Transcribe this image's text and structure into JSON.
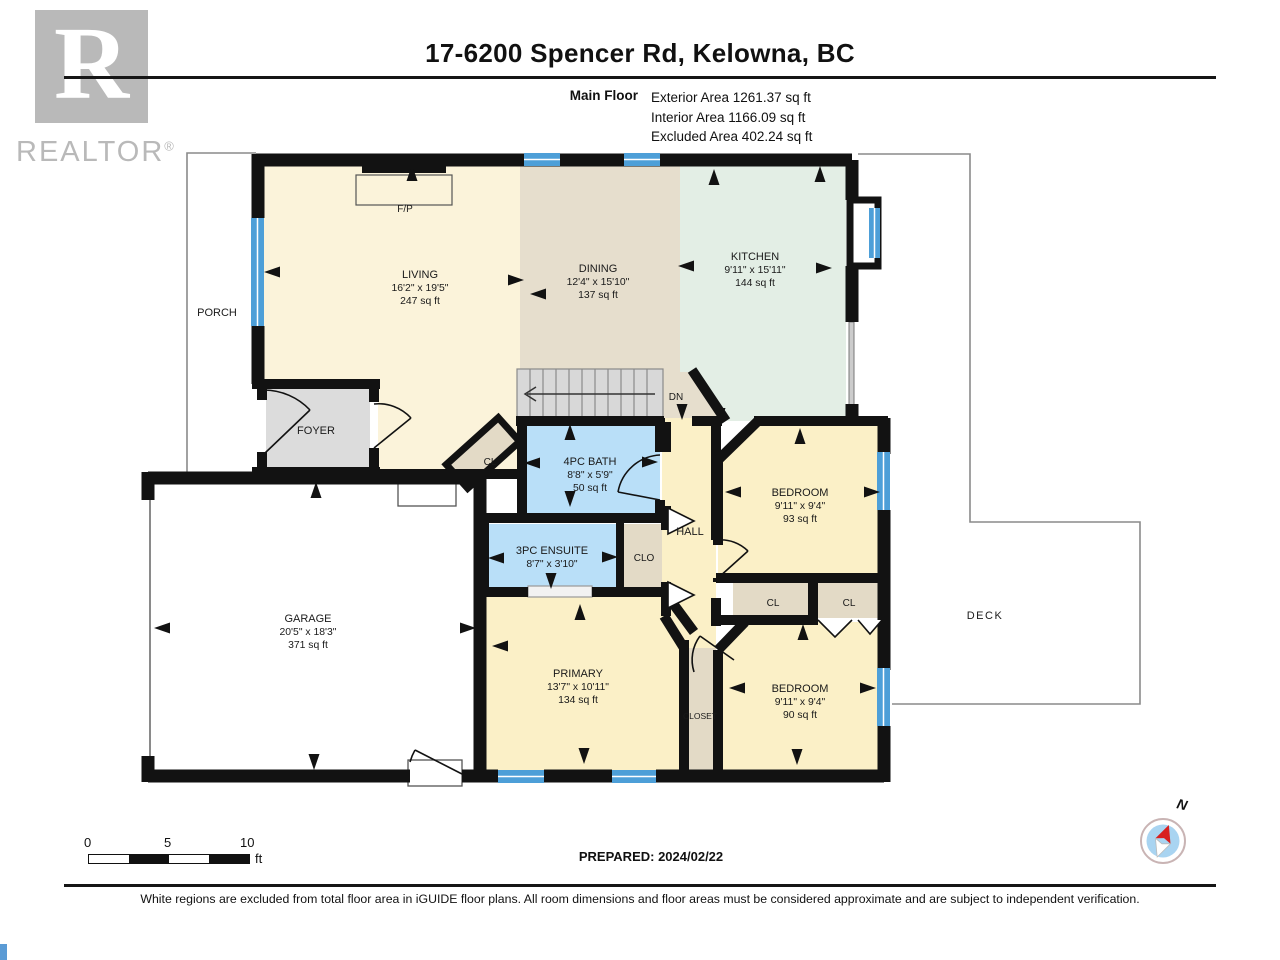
{
  "header": {
    "title": "17-6200 Spencer Rd, Kelowna, BC",
    "floor_label": "Main Floor",
    "areas": [
      "Exterior Area 1261.37 sq ft",
      "Interior Area 1166.09 sq ft",
      "Excluded Area 402.24 sq ft"
    ]
  },
  "logo": {
    "letter": "R",
    "brand": "REALTOR",
    "reg": "®"
  },
  "rooms": {
    "living": {
      "name": "LIVING",
      "dims": "16'2\" x 19'5\"",
      "area": "247 sq ft"
    },
    "dining": {
      "name": "DINING",
      "dims": "12'4\" x 15'10\"",
      "area": "137 sq ft"
    },
    "kitchen": {
      "name": "KITCHEN",
      "dims": "9'11\" x 15'11\"",
      "area": "144 sq ft"
    },
    "bath4": {
      "name": "4PC BATH",
      "dims": "8'8\" x 5'9\"",
      "area": "50 sq ft"
    },
    "ensuite": {
      "name": "3PC ENSUITE",
      "dims": "8'7\" x 3'10\""
    },
    "bedroom1": {
      "name": "BEDROOM",
      "dims": "9'11\" x 9'4\"",
      "area": "93 sq ft"
    },
    "bedroom2": {
      "name": "BEDROOM",
      "dims": "9'11\" x 9'4\"",
      "area": "90 sq ft"
    },
    "primary": {
      "name": "PRIMARY",
      "dims": "13'7\" x 10'11\"",
      "area": "134 sq ft"
    },
    "garage": {
      "name": "GARAGE",
      "dims": "20'5\" x 18'3\"",
      "area": "371 sq ft"
    },
    "foyer": {
      "name": "FOYER"
    },
    "hall": {
      "name": "HALL"
    },
    "porch": {
      "name": "PORCH"
    },
    "deck": {
      "name": "DECK"
    },
    "closet": {
      "name": "CLOSET"
    },
    "clo": {
      "name": "CLO"
    },
    "cl_a": {
      "name": "CL"
    },
    "cl_b": {
      "name": "CL"
    },
    "cl_c": {
      "name": "CL"
    },
    "fireplace": {
      "name": "F/P"
    },
    "stairs": {
      "down_label": "DN"
    }
  },
  "footer": {
    "scale": {
      "t0": "0",
      "t5": "5",
      "t10": "10",
      "unit": "ft"
    },
    "prepared": "PREPARED: 2024/02/22",
    "compass_n": "N",
    "disclaimer": "White regions are excluded from total floor area in iGUIDE floor plans. All room dimensions and floor areas must be considered approximate and are subject to independent verification."
  },
  "colors": {
    "wall": "#121212",
    "living": "#fbf3da",
    "dining": "#e6decd",
    "kitchen": "#e3eee5",
    "bath": "#b9dff8",
    "bedroom": "#fbf0c7",
    "closet": "#e3dac6",
    "foyer_gray": "#dcdcdc",
    "window_blue": "#4d9fd8",
    "compass_blue": "#a9d4f1",
    "compass_red": "#d81f1f"
  }
}
